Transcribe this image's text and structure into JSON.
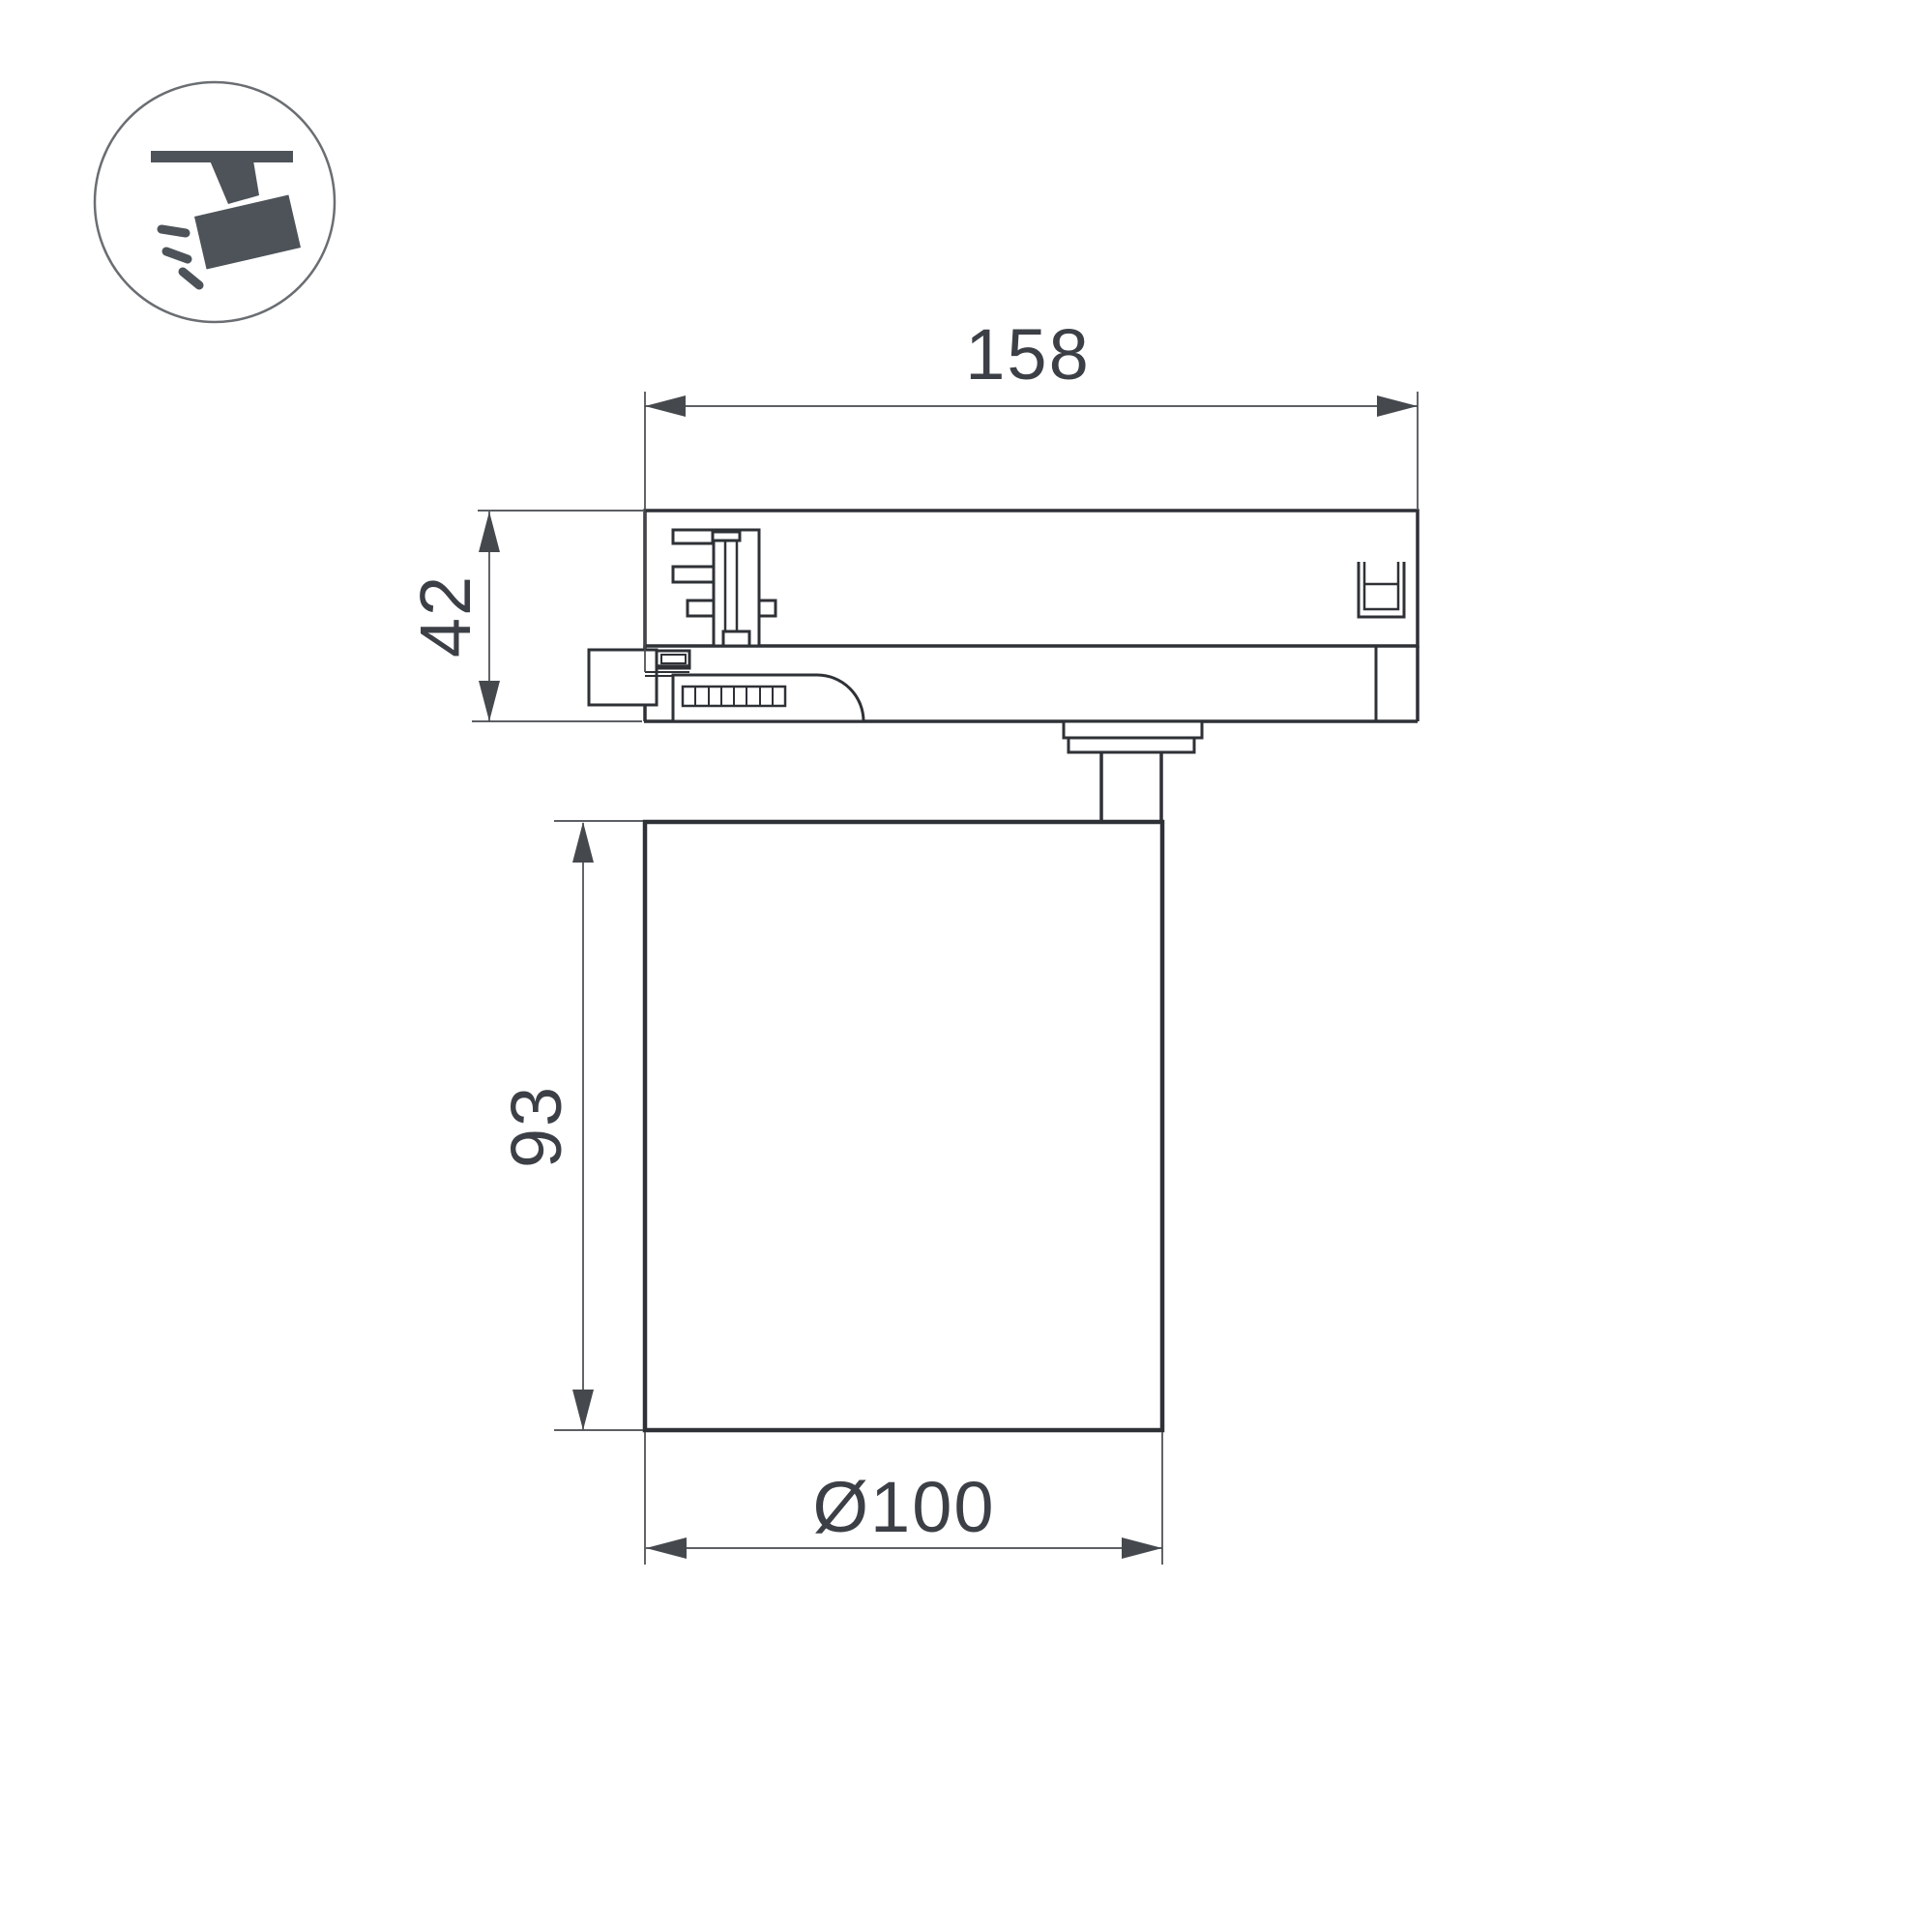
{
  "page": {
    "kind": "technical-dimension-drawing",
    "subject": "track-mounted spotlight side view"
  },
  "icon": {
    "name": "track-spotlight-icon",
    "description": "spotlight hanging from ceiling track, light rays"
  },
  "drawing": {
    "labels": {
      "track_width": "158",
      "adapter_height": "42",
      "body_height": "93",
      "body_diameter": "Ø100"
    }
  },
  "colors": {
    "line": "#2e3136",
    "dim": "#45494e",
    "text": "#3c4046",
    "icon": "#4d5359",
    "ring": "#6a6e72",
    "background": "#ffffff"
  }
}
